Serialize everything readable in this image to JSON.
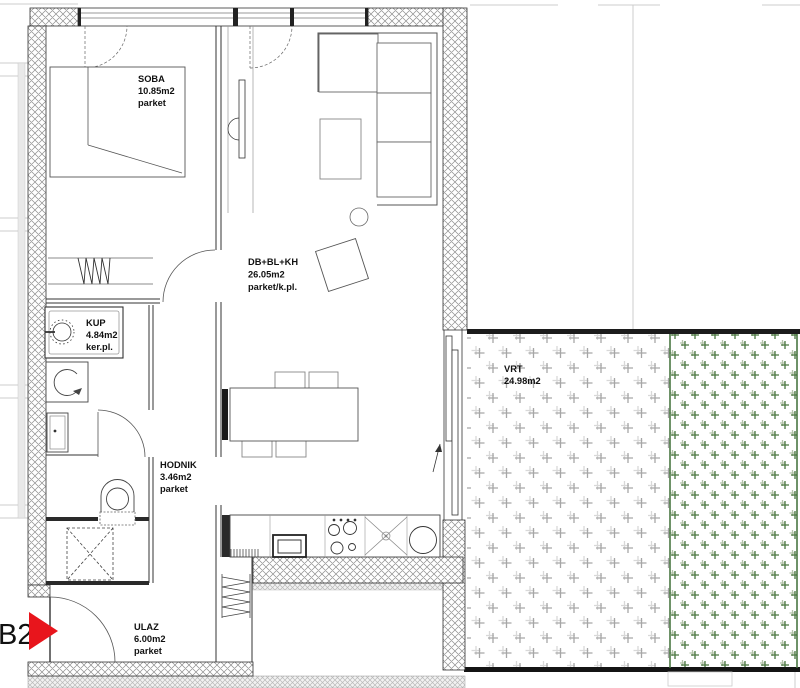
{
  "unit": {
    "label": "B2"
  },
  "rooms": {
    "soba": {
      "name": "SOBA",
      "area": "10.85m2",
      "floor": "parket"
    },
    "living": {
      "name": "DB+BL+KH",
      "area": "26.05m2",
      "floor": "parket/k.pl."
    },
    "kup": {
      "name": "KUP",
      "area": "4.84m2",
      "floor": "ker.pl."
    },
    "hodnik": {
      "name": "HODNIK",
      "area": "3.46m2",
      "floor": "parket"
    },
    "ulaz": {
      "name": "ULAZ",
      "area": "6.00m2",
      "floor": "parket"
    },
    "vrt": {
      "name": "VRT",
      "area": "24.98m2"
    }
  },
  "colors": {
    "marker_red": "#e8151c",
    "garden_green": "#49763f",
    "garden_gray": "#a6a6a6",
    "wall_hatch": "#8e8e8e"
  }
}
